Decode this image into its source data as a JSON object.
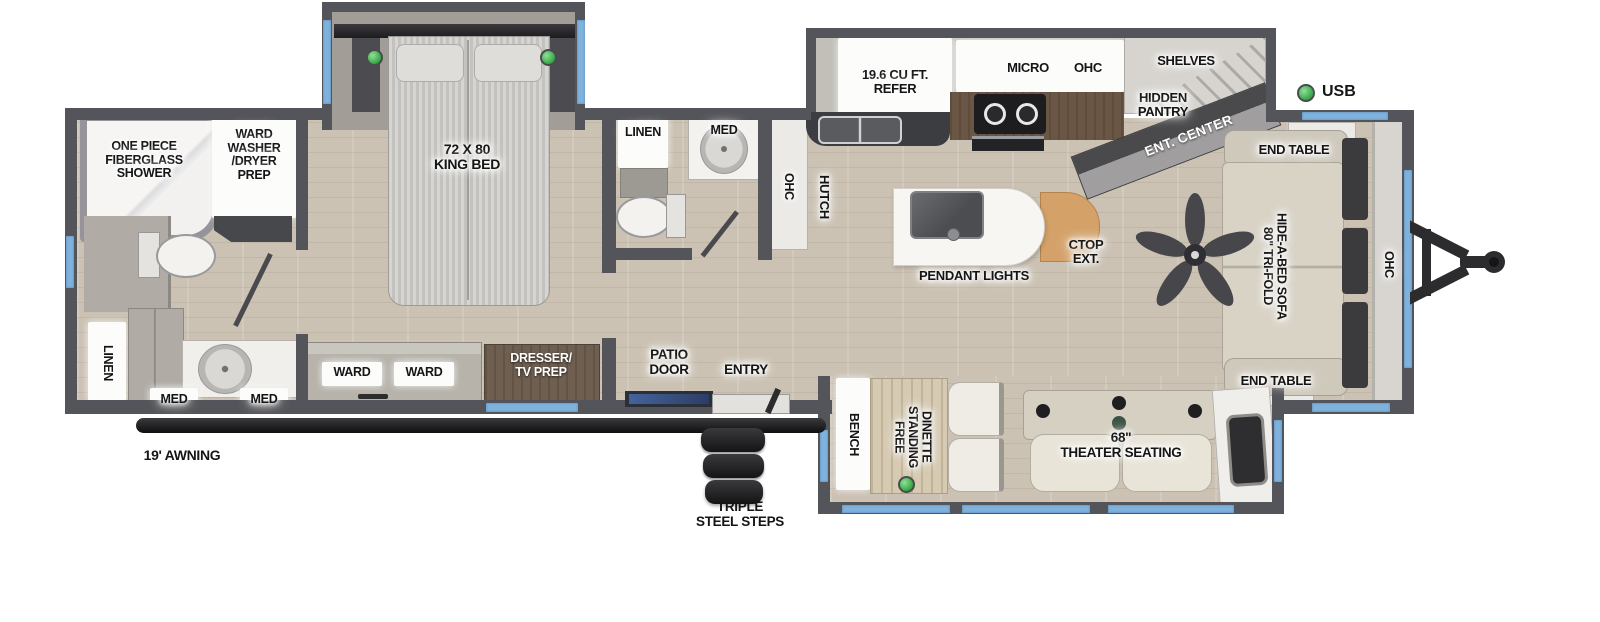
{
  "colors": {
    "wall": "#54555a",
    "window_blue": "#7fb2dd",
    "usb_green": "#2fa33c",
    "floor_wood": "#cbc2b3",
    "counter_wood": "#6a5645",
    "island_ctop": "#d4a269",
    "dark_hardware": "#232326"
  },
  "legend": {
    "usb": "USB"
  },
  "exterior": {
    "awning": "19' AWNING",
    "steps": "TRIPLE\nSTEEL STEPS"
  },
  "rear_bath": {
    "shower": "ONE PIECE\nFIBERGLASS\nSHOWER",
    "washer": "WARD\nWASHER\n/DRYER\nPREP",
    "linen": "LINEN",
    "med_left": "MED",
    "med_right": "MED"
  },
  "bedroom": {
    "bed": "72 X 80\nKING BED",
    "ward_left": "WARD",
    "ward_right": "WARD",
    "dresser": "DRESSER/\nTV PREP"
  },
  "mid_bath": {
    "linen": "LINEN",
    "med": "MED"
  },
  "kitchen": {
    "ohc_hutch": "OHC",
    "hutch": "HUTCH",
    "refer": "19.6 CU FT.\nREFER",
    "micro": "MICRO",
    "ohc": "OHC",
    "shelves": "SHELVES",
    "hidden_pantry": "HIDDEN\nPANTRY",
    "ent_center": "ENT. CENTER",
    "pendant_lights": "PENDANT LIGHTS",
    "ctop_ext": "CTOP\nEXT."
  },
  "entry": {
    "patio_door": "PATIO\nDOOR",
    "entry": "ENTRY"
  },
  "living": {
    "end_table_top": "END TABLE",
    "end_table_bottom": "END TABLE",
    "sofa": "80\" TRI-FOLD\nHIDE-A-BED SOFA",
    "ohc": "OHC",
    "theater": "68\"\nTHEATER SEATING",
    "bench": "BENCH",
    "dinette": "FREE\nSTANDING\nDINETTE"
  }
}
